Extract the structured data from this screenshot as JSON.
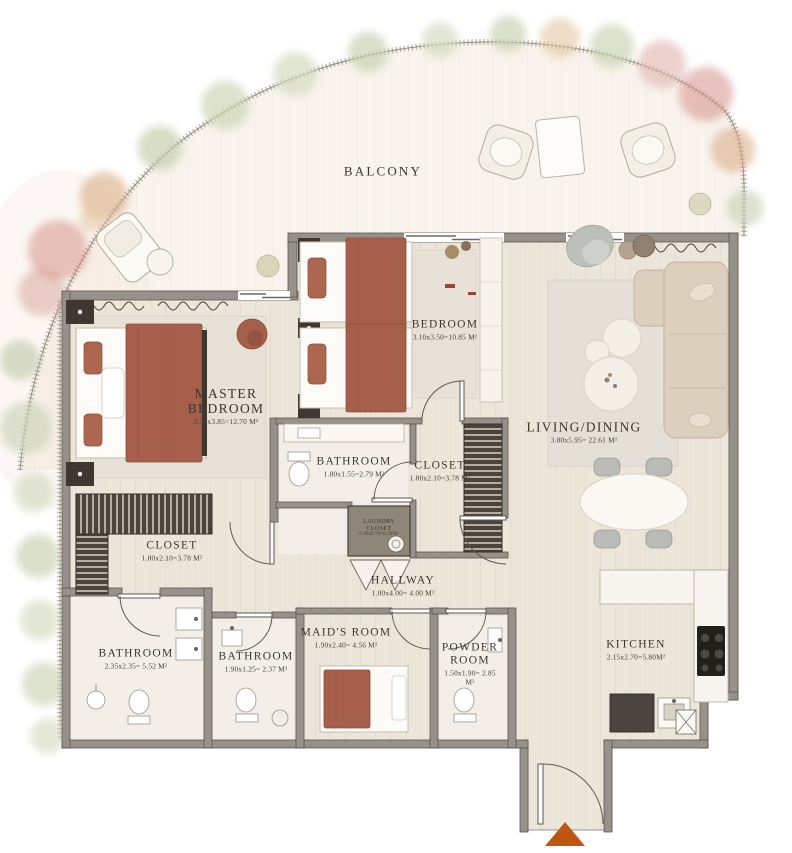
{
  "plan_title": "Apartment Floor Plan",
  "rooms": {
    "balcony": {
      "name": "BALCONY",
      "dims": ""
    },
    "master_bedroom": {
      "name": "MASTER BEDROOM",
      "dims": "3.30x3.85=12.70 M²"
    },
    "bedroom": {
      "name": "BEDROOM",
      "dims": "3.10x3.50=10.85 M²"
    },
    "bathroom_master": {
      "name": "BATHROOM",
      "dims": "1.80x1.55=2.79 M²"
    },
    "closet_bedroom": {
      "name": "CLOSET",
      "dims": "1.80x2.10=3.78 M²"
    },
    "living_dining": {
      "name": "LIVING/DINING",
      "dims": "3.80x5.95= 22.61 M²"
    },
    "laundry_closet": {
      "name": "LAUNDRY CLOSET",
      "dims": "0.80x0.70=0.56M²"
    },
    "hallway": {
      "name": "HALLWAY",
      "dims": "1.00x4.00= 4.00 M²"
    },
    "closet_master": {
      "name": "CLOSET",
      "dims": "1.80x2.10=3.78 M²"
    },
    "bathroom_main": {
      "name": "BATHROOM",
      "dims": "2.35x2.35= 5.52 M²"
    },
    "bathroom_maid": {
      "name": "BATHROOM",
      "dims": "1.90x1.25= 2.37 M²"
    },
    "maids_room": {
      "name": "MAID'S ROOM",
      "dims": "1.90x2.40= 4.56 M²"
    },
    "powder_room": {
      "name": "POWDER ROOM",
      "dims": "1.50x1.90= 2.85 M²"
    },
    "kitchen": {
      "name": "KITCHEN",
      "dims": "2.15x2.70=5.80M²"
    }
  },
  "colors": {
    "wall": "#96918a",
    "floor": "#ece5da",
    "balcony_floor": "#f8f3ec",
    "bed_duvet_rust": "#a55f4a",
    "sofa_beige": "#dccfbd",
    "entrance_arrow_orange": "#bf5512",
    "tree_sage": "#c6cfae",
    "tree_blush": "#e0b9b0",
    "tree_orange": "#dcae8b",
    "label_text": "#3a352e"
  },
  "markers": {
    "entrance_arrow": "entrance-direction-triangle"
  }
}
